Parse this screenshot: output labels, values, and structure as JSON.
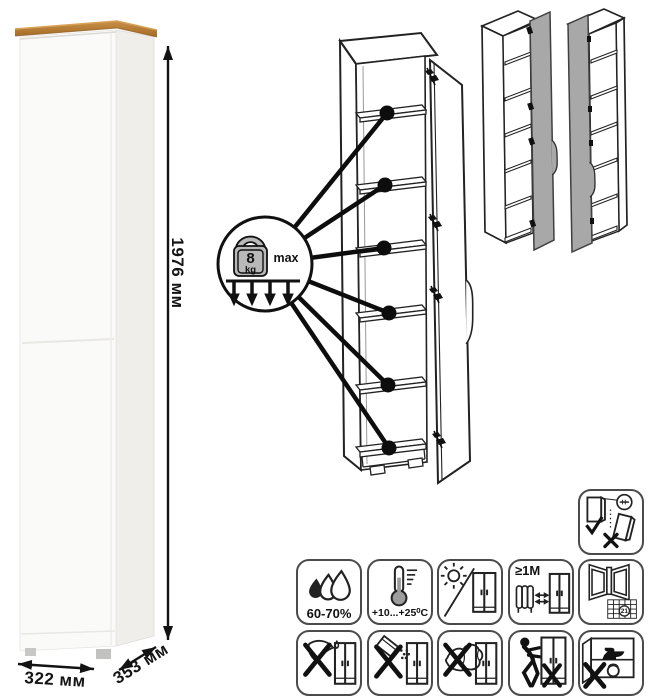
{
  "colors": {
    "wood_top": "#b97c35",
    "cabinet_body": "#faf9f7",
    "line_art": "#1a1a1a",
    "door_fill": "#a8a8a8",
    "weight_fill": "#b9b9b9"
  },
  "dimensions": {
    "height": "1976 мм",
    "width": "322 мм",
    "depth": "353 мм"
  },
  "load_limit": {
    "value": "8",
    "unit": "kg",
    "qualifier": "max",
    "marked_shelves": 6
  },
  "care": {
    "humidity_label": "60-70%",
    "temperature_label": "+10...+25⁰C",
    "min_distance_label": "≥1М",
    "calendar_day": "21"
  },
  "icons": {
    "load": "kettlebell-weight-icon",
    "humidity": "water-drops-icon",
    "temperature": "thermometer-icon",
    "sunlight": "sun-shade-icon",
    "heat_distance": "radiator-distance-icon",
    "ventilation": "open-window-calendar-icon",
    "anti_tip": "wall-anchoring-icon",
    "no_sharp": "no-sharp-tools-icon",
    "no_abrasive": "no-abrasive-powder-icon",
    "no_wet": "no-wet-sponge-icon",
    "no_drag": "no-dragging-icon",
    "no_overload": "no-heavy-load-icon"
  }
}
